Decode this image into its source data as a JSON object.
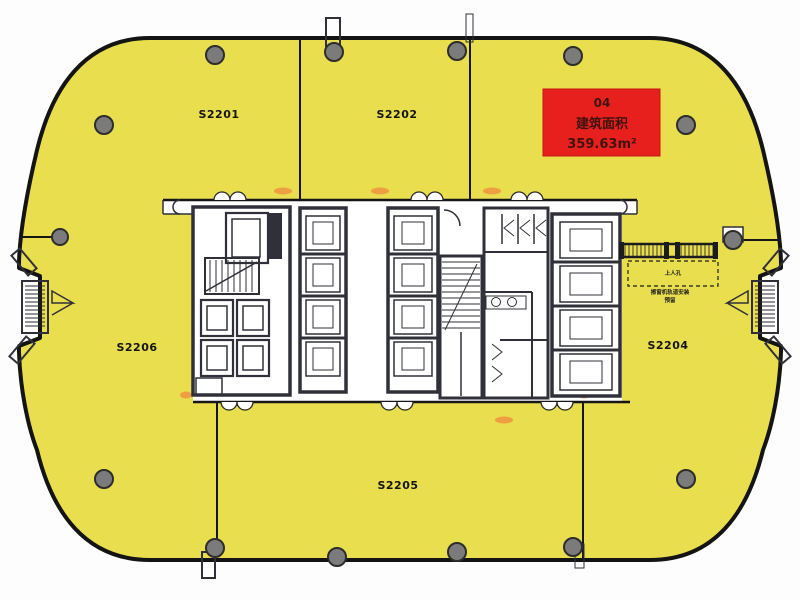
{
  "image_type": "architectural floor plan",
  "rooms": {
    "s2201": {
      "label": "S2201"
    },
    "s2202": {
      "label": "S2202"
    },
    "s2204": {
      "label": "S2204"
    },
    "s2205": {
      "label": "S2205"
    },
    "s2206": {
      "label": "S2206"
    }
  },
  "area_tag": {
    "unit_no": "04",
    "caption": "建筑面积",
    "area": "359.63m²"
  },
  "annotations": {
    "hatch_label": "上人孔",
    "note_line1": "擦窗机轨道安装",
    "note_line2": "预留"
  },
  "colors": {
    "slab_yellow": "#e9df4e",
    "outline_black": "#141414",
    "column_gray": "#7b7b7b",
    "unit_red": "#e8201d",
    "door_orange": "#f08a3e"
  }
}
